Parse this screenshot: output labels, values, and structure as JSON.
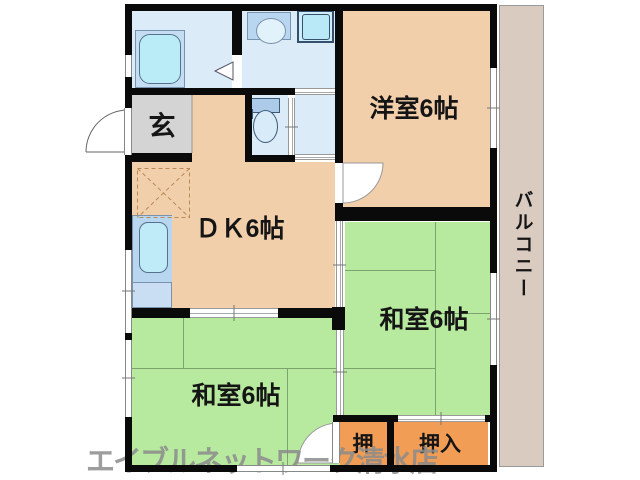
{
  "plan": {
    "labels": {
      "genkan": "玄",
      "dk": "ＤＫ6帖",
      "western_room": "洋室6帖",
      "japanese_room_right": "和室6帖",
      "japanese_room_bottom": "和室6帖",
      "closet_small": "押",
      "closet_large": "押入",
      "balcony": "バルコニー"
    },
    "watermark": "エイブルネットワーク清水店",
    "colors": {
      "wall": "#0a0a0a",
      "room_peach": "#f2cfab",
      "tatami_green": "#b7ea9f",
      "closet_orange": "#f19d56",
      "wet_area_blue": "#dcebf8",
      "genkan_gray": "#d4d4d4",
      "balcony_beige": "#d9cbc0",
      "fixture_cyan": "#baecf8",
      "watermark_gray": "#8c8c8c"
    }
  }
}
